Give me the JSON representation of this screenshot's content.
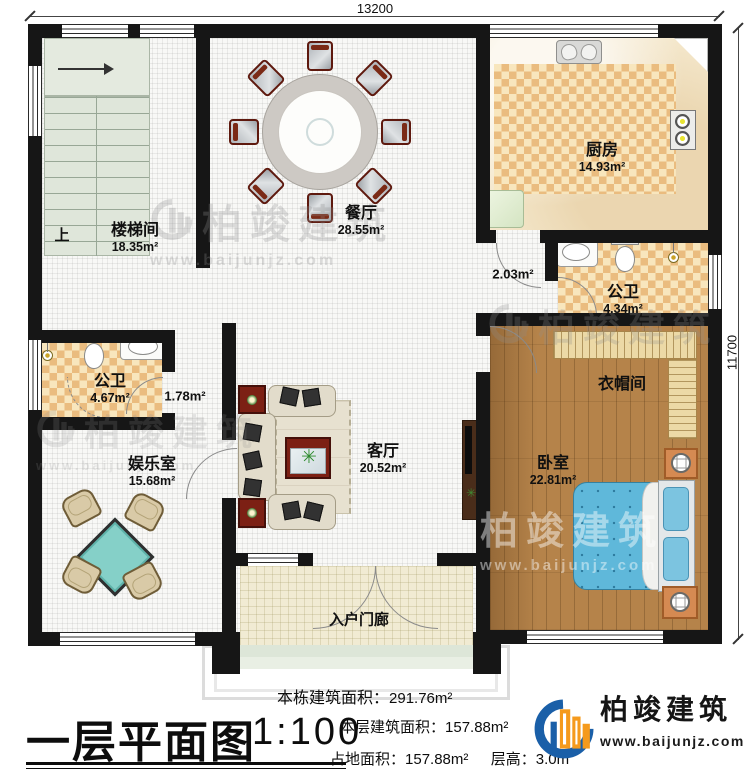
{
  "meta": {
    "title": "一层平面图",
    "scale": "1:100"
  },
  "dimensions": {
    "top": "13200",
    "right": "11700"
  },
  "stair": {
    "up_label": "上"
  },
  "rooms": {
    "stairwell": {
      "name": "楼梯间",
      "area": "18.35m²"
    },
    "dining": {
      "name": "餐厅",
      "area": "28.55m²"
    },
    "kitchen": {
      "name": "厨房",
      "area": "14.93m²"
    },
    "bath_right": {
      "name": "公卫",
      "area": "4.34m²"
    },
    "hall_right": {
      "area": "2.03m²"
    },
    "cloakroom": {
      "name": "衣帽间"
    },
    "bedroom": {
      "name": "卧室",
      "area": "22.81m²"
    },
    "living": {
      "name": "客厅",
      "area": "20.52m²"
    },
    "bath_left": {
      "name": "公卫",
      "area": "4.67m²"
    },
    "hall_left": {
      "area": "1.78m²"
    },
    "entertainment": {
      "name": "娱乐室",
      "area": "15.68m²"
    },
    "porch": {
      "name": "入户门廊"
    }
  },
  "stats": {
    "building_total": {
      "label": "本栋建筑面积：",
      "value": "291.76m²"
    },
    "floor_area": {
      "label": "本层建筑面积：",
      "value": "157.88m²"
    },
    "footprint": {
      "label": "占地面积：",
      "value": "157.88m²"
    },
    "floor_height": {
      "label": "层高：",
      "value": "3.0m"
    }
  },
  "brand": {
    "name": "柏竣建筑",
    "url": "www.baijunjz.com"
  },
  "colors": {
    "wall": "#161616",
    "tile_dark": "#eabc7f",
    "tile_light": "#f8e6bd",
    "wood": "#b5834a",
    "bed_blue": "#5fb8da",
    "mahjong_teal": "#85d0c8",
    "logo_blue": "#1a5fa8",
    "logo_orange": "#f59a1c"
  }
}
